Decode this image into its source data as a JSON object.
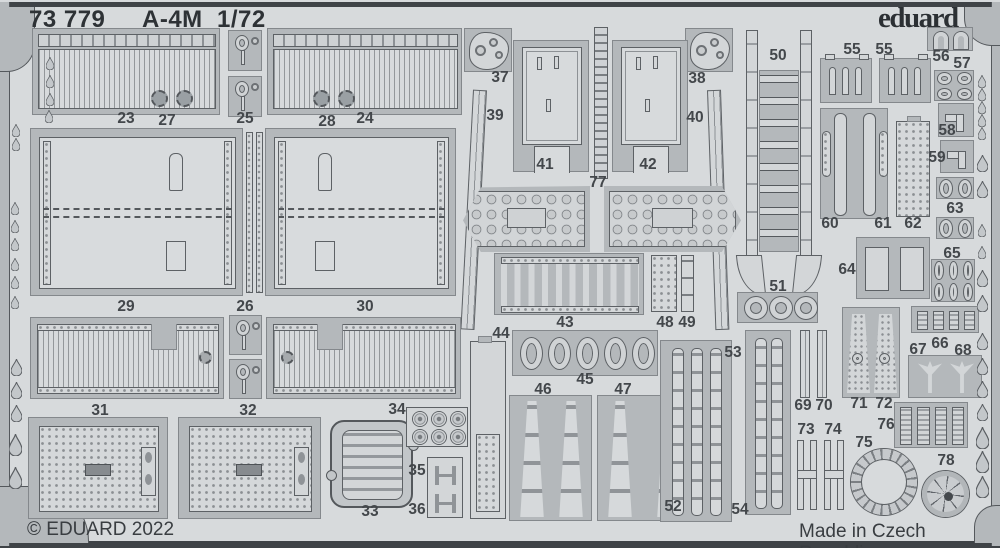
{
  "header": {
    "catalog": "73 779",
    "model": "A-4M",
    "scale": "1/72",
    "brand": "eduard"
  },
  "footer": {
    "copyright": "© EDUARD 2022",
    "origin": "Made in Czech Republic"
  },
  "colors": {
    "sheet": "#d7dadc",
    "carrier": "#b4b8bb",
    "part_light": "#d3d6d8",
    "outline": "#5d6165",
    "frame_bar": "#3f4347",
    "text": "#2e3236",
    "label": "#43474b"
  },
  "part_labels": [
    {
      "t": "23",
      "x": 126,
      "y": 119
    },
    {
      "t": "27",
      "x": 167,
      "y": 121
    },
    {
      "t": "25",
      "x": 245,
      "y": 119
    },
    {
      "t": "28",
      "x": 327,
      "y": 122
    },
    {
      "t": "24",
      "x": 365,
      "y": 119
    },
    {
      "t": "37",
      "x": 500,
      "y": 78
    },
    {
      "t": "39",
      "x": 495,
      "y": 116
    },
    {
      "t": "41",
      "x": 545,
      "y": 165
    },
    {
      "t": "77",
      "x": 598,
      "y": 183
    },
    {
      "t": "42",
      "x": 648,
      "y": 165
    },
    {
      "t": "38",
      "x": 697,
      "y": 79
    },
    {
      "t": "40",
      "x": 695,
      "y": 118
    },
    {
      "t": "50",
      "x": 778,
      "y": 56
    },
    {
      "t": "55",
      "x": 852,
      "y": 50
    },
    {
      "t": "55",
      "x": 884,
      "y": 50
    },
    {
      "t": "56",
      "x": 941,
      "y": 57
    },
    {
      "t": "57",
      "x": 962,
      "y": 64
    },
    {
      "t": "58",
      "x": 947,
      "y": 131
    },
    {
      "t": "59",
      "x": 937,
      "y": 158
    },
    {
      "t": "60",
      "x": 830,
      "y": 224
    },
    {
      "t": "61",
      "x": 883,
      "y": 224
    },
    {
      "t": "62",
      "x": 913,
      "y": 224
    },
    {
      "t": "63",
      "x": 955,
      "y": 209
    },
    {
      "t": "64",
      "x": 847,
      "y": 270
    },
    {
      "t": "65",
      "x": 952,
      "y": 254
    },
    {
      "t": "29",
      "x": 126,
      "y": 307
    },
    {
      "t": "26",
      "x": 245,
      "y": 307
    },
    {
      "t": "30",
      "x": 365,
      "y": 307
    },
    {
      "t": "43",
      "x": 565,
      "y": 323
    },
    {
      "t": "48",
      "x": 665,
      "y": 323
    },
    {
      "t": "49",
      "x": 687,
      "y": 323
    },
    {
      "t": "44",
      "x": 501,
      "y": 334
    },
    {
      "t": "51",
      "x": 778,
      "y": 287
    },
    {
      "t": "53",
      "x": 733,
      "y": 353
    },
    {
      "t": "45",
      "x": 585,
      "y": 380
    },
    {
      "t": "46",
      "x": 543,
      "y": 390
    },
    {
      "t": "47",
      "x": 623,
      "y": 390
    },
    {
      "t": "66",
      "x": 940,
      "y": 344
    },
    {
      "t": "67",
      "x": 918,
      "y": 350
    },
    {
      "t": "68",
      "x": 963,
      "y": 351
    },
    {
      "t": "31",
      "x": 100,
      "y": 411
    },
    {
      "t": "32",
      "x": 248,
      "y": 411
    },
    {
      "t": "34",
      "x": 397,
      "y": 410
    },
    {
      "t": "35",
      "x": 417,
      "y": 471
    },
    {
      "t": "36",
      "x": 417,
      "y": 510
    },
    {
      "t": "33",
      "x": 370,
      "y": 512
    },
    {
      "t": "69",
      "x": 803,
      "y": 406
    },
    {
      "t": "70",
      "x": 824,
      "y": 406
    },
    {
      "t": "71",
      "x": 859,
      "y": 404
    },
    {
      "t": "72",
      "x": 884,
      "y": 404
    },
    {
      "t": "73",
      "x": 806,
      "y": 430
    },
    {
      "t": "74",
      "x": 833,
      "y": 430
    },
    {
      "t": "76",
      "x": 886,
      "y": 425
    },
    {
      "t": "75",
      "x": 864,
      "y": 443
    },
    {
      "t": "78",
      "x": 946,
      "y": 461
    },
    {
      "t": "52",
      "x": 673,
      "y": 507
    },
    {
      "t": "54",
      "x": 740,
      "y": 510
    }
  ],
  "parts": [
    {
      "n": "23-27",
      "k": "flap",
      "x": 32,
      "y": 28,
      "w": 188,
      "h": 87,
      "gx": [
        118,
        143
      ]
    },
    {
      "n": "28-24",
      "k": "flap",
      "x": 267,
      "y": 28,
      "w": 195,
      "h": 87,
      "gx": [
        45,
        70
      ]
    },
    {
      "n": "25a",
      "k": "hooks",
      "x": 228,
      "y": 30,
      "w": 34,
      "h": 41
    },
    {
      "n": "25b",
      "k": "hooks",
      "x": 228,
      "y": 76,
      "w": 34,
      "h": 41
    },
    {
      "n": "37",
      "k": "tri",
      "x": 464,
      "y": 28,
      "w": 48,
      "h": 44
    },
    {
      "n": "38",
      "k": "tri",
      "x": 685,
      "y": 28,
      "w": 48,
      "h": 44
    },
    {
      "n": "41",
      "k": "seat",
      "x": 513,
      "y": 40,
      "w": 76,
      "h": 132
    },
    {
      "n": "42",
      "k": "seat",
      "x": 612,
      "y": 40,
      "w": 76,
      "h": 132
    },
    {
      "n": "77",
      "k": "vladder",
      "x": 594,
      "y": 27,
      "w": 14,
      "h": 152
    },
    {
      "n": "39",
      "k": "thin",
      "x": 473,
      "y": 90,
      "w": 14,
      "h": 240,
      "rot": 3
    },
    {
      "n": "40",
      "k": "thin",
      "x": 707,
      "y": 90,
      "w": 14,
      "h": 240,
      "rot": -2
    },
    {
      "n": "50",
      "k": "bigladder",
      "x": 746,
      "y": 30,
      "w": 66,
      "h": 265
    },
    {
      "n": "55a",
      "k": "comb",
      "x": 820,
      "y": 58,
      "w": 52,
      "h": 45
    },
    {
      "n": "55b",
      "k": "comb",
      "x": 879,
      "y": 58,
      "w": 52,
      "h": 45
    },
    {
      "n": "56",
      "k": "uplate",
      "x": 927,
      "y": 27,
      "w": 46,
      "h": 24
    },
    {
      "n": "57",
      "k": "rings",
      "x": 934,
      "y": 70,
      "w": 40,
      "h": 31,
      "rows": 2,
      "cols": 2
    },
    {
      "n": "58",
      "k": "elbow",
      "x": 938,
      "y": 103,
      "w": 36,
      "h": 34
    },
    {
      "n": "59",
      "k": "elbow",
      "x": 940,
      "y": 140,
      "w": 34,
      "h": 33
    },
    {
      "n": "63a",
      "k": "rings",
      "x": 936,
      "y": 177,
      "w": 38,
      "h": 22,
      "rows": 1,
      "cols": 2
    },
    {
      "n": "63b",
      "k": "rings",
      "x": 936,
      "y": 217,
      "w": 38,
      "h": 22,
      "rows": 1,
      "cols": 2
    },
    {
      "n": "60-61",
      "k": "spars",
      "x": 820,
      "y": 108,
      "w": 68,
      "h": 111
    },
    {
      "n": "62",
      "k": "holes",
      "x": 896,
      "y": 121,
      "w": 34,
      "h": 96
    },
    {
      "n": "64",
      "k": "boxes",
      "x": 856,
      "y": 237,
      "w": 74,
      "h": 62
    },
    {
      "n": "65",
      "k": "rings",
      "x": 931,
      "y": 259,
      "w": 44,
      "h": 43,
      "rows": 2,
      "cols": 3
    },
    {
      "n": "29",
      "k": "bigpanel",
      "x": 30,
      "y": 128,
      "w": 213,
      "h": 168,
      "bx": 138
    },
    {
      "n": "30",
      "k": "bigpanel",
      "x": 265,
      "y": 128,
      "w": 191,
      "h": 168,
      "bx": 52
    },
    {
      "n": "26a",
      "k": "dstrip",
      "x": 246,
      "y": 132,
      "w": 7,
      "h": 161
    },
    {
      "n": "26b",
      "k": "dstrip",
      "x": 256,
      "y": 132,
      "w": 7,
      "h": 161
    },
    {
      "n": "console-left",
      "k": "console",
      "x": 463,
      "y": 186,
      "w": 127,
      "h": 66,
      "point": "left"
    },
    {
      "n": "console-right",
      "k": "console",
      "x": 604,
      "y": 186,
      "w": 137,
      "h": 66,
      "point": "right"
    },
    {
      "n": "slat-left",
      "k": "slat",
      "x": 30,
      "y": 317,
      "w": 194,
      "h": 82,
      "nx": 120,
      "gx2": 168
    },
    {
      "n": "slat-right",
      "k": "slat",
      "x": 266,
      "y": 317,
      "w": 195,
      "h": 82,
      "nx": 50,
      "gx2": 14
    },
    {
      "n": "hook-c1",
      "k": "hooks",
      "x": 229,
      "y": 315,
      "w": 33,
      "h": 40
    },
    {
      "n": "hook-c2",
      "k": "hooks",
      "x": 229,
      "y": 359,
      "w": 33,
      "h": 40
    },
    {
      "n": "43",
      "k": "beltrow",
      "x": 494,
      "y": 253,
      "w": 150,
      "h": 62
    },
    {
      "n": "48",
      "k": "perf",
      "x": 651,
      "y": 255,
      "w": 26,
      "h": 57
    },
    {
      "n": "49",
      "k": "seg",
      "x": 681,
      "y": 255,
      "w": 13,
      "h": 57
    },
    {
      "n": "45",
      "k": "ovalrow",
      "x": 512,
      "y": 330,
      "w": 146,
      "h": 46
    },
    {
      "n": "44",
      "k": "tallpanel",
      "x": 470,
      "y": 341,
      "w": 36,
      "h": 178
    },
    {
      "n": "46",
      "k": "beltpair",
      "x": 509,
      "y": 395,
      "w": 83,
      "h": 126
    },
    {
      "n": "47",
      "k": "beltpair",
      "x": 597,
      "y": 395,
      "w": 93,
      "h": 126
    },
    {
      "n": "51",
      "k": "circlerow",
      "x": 737,
      "y": 292,
      "w": 81,
      "h": 31
    },
    {
      "n": "52",
      "k": "beltplate",
      "x": 660,
      "y": 340,
      "w": 72,
      "h": 182,
      "belts": 3
    },
    {
      "n": "53-54",
      "k": "beltplate",
      "x": 745,
      "y": 330,
      "w": 46,
      "h": 185,
      "belts": 2
    },
    {
      "n": "31",
      "k": "fusel",
      "x": 28,
      "y": 417,
      "w": 140,
      "h": 102
    },
    {
      "n": "32",
      "k": "fusel",
      "x": 178,
      "y": 417,
      "w": 143,
      "h": 102
    },
    {
      "n": "33",
      "k": "grille",
      "x": 330,
      "y": 420,
      "w": 83,
      "h": 88
    },
    {
      "n": "34",
      "k": "discs",
      "x": 406,
      "y": 407,
      "w": 62,
      "h": 40
    },
    {
      "n": "35-36",
      "k": "hbrackets",
      "x": 427,
      "y": 457,
      "w": 36,
      "h": 61
    },
    {
      "n": "66",
      "k": "ribs",
      "x": 911,
      "y": 306,
      "w": 68,
      "h": 27,
      "nribs": 4
    },
    {
      "n": "67-68",
      "k": "anchors",
      "x": 908,
      "y": 355,
      "w": 74,
      "h": 43
    },
    {
      "n": "69-70",
      "k": "strips2",
      "x": 800,
      "y": 330,
      "w": 28,
      "h": 68
    },
    {
      "n": "71-72",
      "k": "twinpanel",
      "x": 842,
      "y": 307,
      "w": 58,
      "h": 91
    },
    {
      "n": "73-74",
      "k": "hbeam",
      "x": 797,
      "y": 436,
      "w": 48,
      "h": 78
    },
    {
      "n": "76",
      "k": "ribs",
      "x": 894,
      "y": 402,
      "w": 74,
      "h": 46,
      "nribs": 4
    },
    {
      "n": "75",
      "k": "bigring",
      "x": 851,
      "y": 449,
      "w": 66,
      "h": 66
    },
    {
      "n": "78",
      "k": "wheel",
      "x": 922,
      "y": 471,
      "w": 47,
      "h": 46
    }
  ],
  "frame": {
    "drops_left": [
      {
        "x": 50,
        "y": 63,
        "s": 1
      },
      {
        "x": 50,
        "y": 81,
        "s": 1
      },
      {
        "x": 50,
        "y": 99,
        "s": 1
      },
      {
        "x": 49,
        "y": 116,
        "s": 1
      },
      {
        "x": 16,
        "y": 130,
        "s": 1
      },
      {
        "x": 16,
        "y": 144,
        "s": 1
      },
      {
        "x": 15,
        "y": 208,
        "s": 1
      },
      {
        "x": 15,
        "y": 226,
        "s": 1
      },
      {
        "x": 15,
        "y": 244,
        "s": 1
      },
      {
        "x": 15,
        "y": 264,
        "s": 1
      },
      {
        "x": 15,
        "y": 282,
        "s": 1
      },
      {
        "x": 15,
        "y": 302,
        "s": 1
      },
      {
        "x": 16,
        "y": 367,
        "s": 2
      },
      {
        "x": 16,
        "y": 390,
        "s": 2
      },
      {
        "x": 16,
        "y": 413,
        "s": 2
      },
      {
        "x": 15,
        "y": 445,
        "s": 3
      },
      {
        "x": 15,
        "y": 478,
        "s": 3
      }
    ],
    "drops_right": [
      {
        "x": 982,
        "y": 81,
        "s": 1
      },
      {
        "x": 982,
        "y": 94,
        "s": 1
      },
      {
        "x": 982,
        "y": 107,
        "s": 1
      },
      {
        "x": 982,
        "y": 120,
        "s": 1
      },
      {
        "x": 982,
        "y": 133,
        "s": 1
      },
      {
        "x": 982,
        "y": 163,
        "s": 2
      },
      {
        "x": 982,
        "y": 189,
        "s": 2
      },
      {
        "x": 982,
        "y": 230,
        "s": 1
      },
      {
        "x": 982,
        "y": 252,
        "s": 1
      },
      {
        "x": 982,
        "y": 278,
        "s": 2
      },
      {
        "x": 982,
        "y": 303,
        "s": 2
      },
      {
        "x": 982,
        "y": 341,
        "s": 2
      },
      {
        "x": 982,
        "y": 366,
        "s": 2
      },
      {
        "x": 982,
        "y": 389,
        "s": 2
      },
      {
        "x": 982,
        "y": 412,
        "s": 2
      },
      {
        "x": 982,
        "y": 438,
        "s": 3
      },
      {
        "x": 982,
        "y": 462,
        "s": 3
      },
      {
        "x": 982,
        "y": 487,
        "s": 3
      }
    ]
  }
}
